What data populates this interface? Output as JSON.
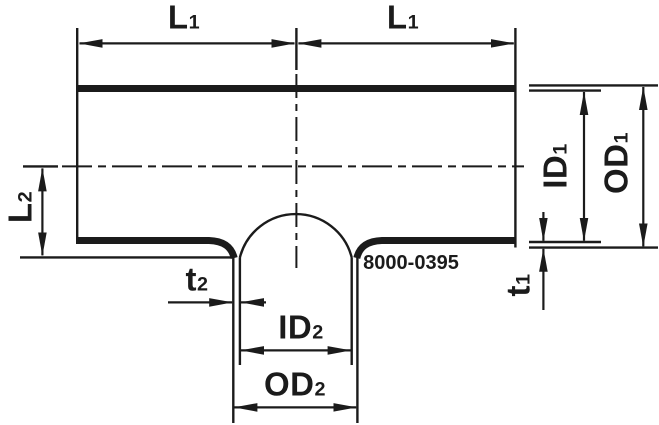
{
  "figure": {
    "type": "technical-drawing-tee-fitting-cross-section",
    "background_color": "#ffffff",
    "line_color": "#1b1b1b",
    "part_number": "8000-0395",
    "labels": {
      "l1_left": {
        "base": "L",
        "sub": "1"
      },
      "l1_right": {
        "base": "L",
        "sub": "1"
      },
      "l2": {
        "base": "L",
        "sub": "2"
      },
      "id1": {
        "base": "ID",
        "sub": "1"
      },
      "od1": {
        "base": "OD",
        "sub": "1"
      },
      "t1": {
        "base": "t",
        "sub": "1"
      },
      "t2": {
        "base": "t",
        "sub": "2"
      },
      "id2": {
        "base": "ID",
        "sub": "2"
      },
      "od2": {
        "base": "OD",
        "sub": "2"
      }
    }
  }
}
